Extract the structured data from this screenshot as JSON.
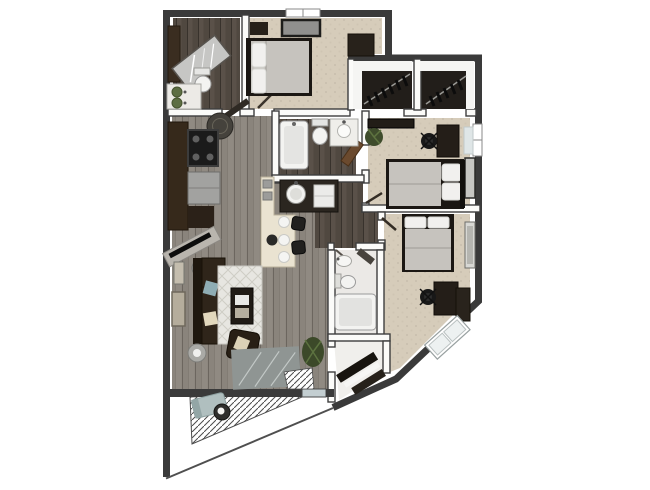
{
  "meta": {
    "scene": "3D rendered apartment floor plan, top-down dollhouse view, no text labels",
    "canvas": {
      "width": 650,
      "height": 490
    }
  },
  "colors": {
    "background": "#ffffff",
    "wall": "#3a3a3a",
    "wall_edge": "#4f4f4f",
    "wall_face": "#fbfbf9",
    "floor_wood": "#8a847c",
    "floor_wood_dark": "#5a5149",
    "carpet": "#d6ccba",
    "tile": "#ebe9e6",
    "closet_interior": "#221e1a",
    "island": "#eae3d1",
    "counter_dark": "#2b2620",
    "cabinet_brown": "#36291b",
    "appliance_gray": "#a2a2a0",
    "sofa_brown": "#2f251a",
    "rug": "#e7e6e1",
    "duvet_gray": "#c6c3be",
    "linen_white": "#f1f0ee",
    "furniture_dark": "#241e18",
    "plant_green": "#3f4c2c",
    "patio_chair": "#b0bfbf",
    "glass": "#c3ced1",
    "door_brown": "#6b4a2e",
    "mat_gray": "#8f9593",
    "fixture_white": "#f3f3f1"
  },
  "rooms": [
    {
      "name": "bathroom-1",
      "floor": "dark-wood",
      "features": [
        "corner-shower",
        "toilet",
        "vanity-with-green-bowls",
        "tall-cabinet"
      ]
    },
    {
      "name": "bedroom-1",
      "floor": "carpet",
      "features": [
        "bed",
        "nightstand",
        "wall-art",
        "window",
        "dresser"
      ]
    },
    {
      "name": "walk-in-closet-1",
      "floor": "dark",
      "features": [
        "white-shelf",
        "hanging-clothes"
      ]
    },
    {
      "name": "walk-in-closet-2",
      "floor": "dark",
      "features": [
        "white-shelf",
        "hanging-clothes"
      ]
    },
    {
      "name": "bedroom-2",
      "floor": "carpet",
      "features": [
        "bed",
        "desk",
        "office-chair",
        "tv-console",
        "plant",
        "window",
        "wall-art"
      ]
    },
    {
      "name": "bathroom-2",
      "floor": "dark-wood",
      "features": [
        "bathtub",
        "toilet",
        "vanity",
        "open-door"
      ]
    },
    {
      "name": "kitchen",
      "floor": "gray-wood",
      "features": [
        "range",
        "refrigerator",
        "cabinets",
        "counter-with-sink",
        "dishwasher",
        "island",
        "bar-stools",
        "round-rug"
      ]
    },
    {
      "name": "living-room",
      "floor": "gray-wood",
      "features": [
        "sofa",
        "armchair",
        "coffee-table",
        "rug",
        "tv-console",
        "floor-lamp",
        "side-table",
        "plant",
        "wall-art",
        "entry-mat"
      ]
    },
    {
      "name": "hallway",
      "floor": "dark-wood",
      "features": []
    },
    {
      "name": "bathroom-3",
      "floor": "tile",
      "features": [
        "sink",
        "toilet",
        "bathtub"
      ]
    },
    {
      "name": "linen-closet",
      "floor": "tile",
      "features": [
        "angled-shelving"
      ]
    },
    {
      "name": "bedroom-3",
      "floor": "carpet",
      "features": [
        "bed",
        "desk",
        "office-chair",
        "dresser",
        "angled-window",
        "wall-art"
      ]
    },
    {
      "name": "balcony",
      "floor": "hatched-decking",
      "features": [
        "lounge-chair",
        "round-table"
      ]
    }
  ]
}
